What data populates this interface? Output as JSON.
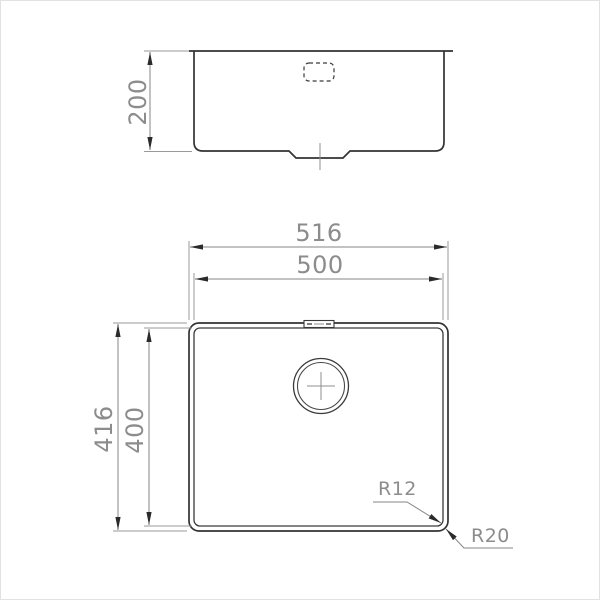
{
  "colors": {
    "background": "#ffffff",
    "frame_border": "#e2e2e2",
    "object_line": "#333333",
    "dimension_line": "#858585",
    "extension_line": "#9a9a9a",
    "arrow": "#2b2b2b",
    "dimension_text": "#8c8c8c"
  },
  "front_view": {
    "depth_dim": "200"
  },
  "plan_view": {
    "overall_width_dim": "516",
    "bowl_width_dim": "500",
    "overall_depth_dim": "416",
    "bowl_depth_dim": "400",
    "bowl_corner_radius": "R12",
    "rim_corner_radius": "R20"
  }
}
